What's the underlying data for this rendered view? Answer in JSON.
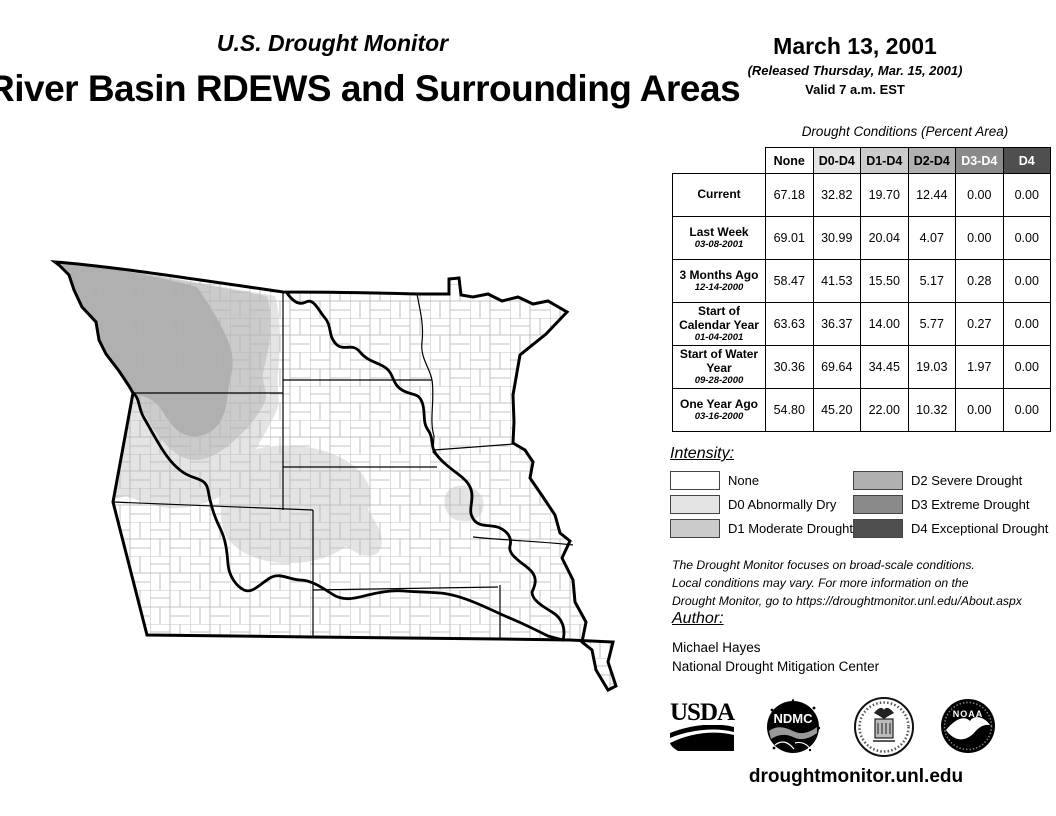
{
  "header": {
    "monitor_title": "U.S. Drought Monitor",
    "main_title": "River Basin RDEWS and Surrounding Areas",
    "date": "March 13, 2001",
    "released": "(Released Thursday, Mar. 15, 2001)",
    "valid": "Valid 7 a.m. EST"
  },
  "table": {
    "title": "Drought Conditions (Percent Area)",
    "columns": [
      "None",
      "D0-D4",
      "D1-D4",
      "D2-D4",
      "D3-D4",
      "D4"
    ],
    "header_bg": [
      "#ffffff",
      "#e4e4e4",
      "#cbcbcb",
      "#b0b0b0",
      "#8a8a8a",
      "#4f4f4f"
    ],
    "header_fg": [
      "#000000",
      "#000000",
      "#000000",
      "#000000",
      "#ffffff",
      "#ffffff"
    ],
    "rows": [
      {
        "label": "Current",
        "date": "",
        "values": [
          "67.18",
          "32.82",
          "19.70",
          "12.44",
          "0.00",
          "0.00"
        ]
      },
      {
        "label": "Last Week",
        "date": "03-08-2001",
        "values": [
          "69.01",
          "30.99",
          "20.04",
          "4.07",
          "0.00",
          "0.00"
        ]
      },
      {
        "label": "3 Months Ago",
        "date": "12-14-2000",
        "values": [
          "58.47",
          "41.53",
          "15.50",
          "5.17",
          "0.28",
          "0.00"
        ]
      },
      {
        "label": "Start of Calendar Year",
        "date": "01-04-2001",
        "values": [
          "63.63",
          "36.37",
          "14.00",
          "5.77",
          "0.27",
          "0.00"
        ]
      },
      {
        "label": "Start of Water Year",
        "date": "09-28-2000",
        "values": [
          "30.36",
          "69.64",
          "34.45",
          "19.03",
          "1.97",
          "0.00"
        ]
      },
      {
        "label": "One Year Ago",
        "date": "03-16-2000",
        "values": [
          "54.80",
          "45.20",
          "22.00",
          "10.32",
          "0.00",
          "0.00"
        ]
      }
    ]
  },
  "legend": {
    "title": "Intensity:",
    "items": [
      {
        "label": "None",
        "color": "#ffffff"
      },
      {
        "label": "D0 Abnormally Dry",
        "color": "#e4e4e4"
      },
      {
        "label": "D1 Moderate Drought",
        "color": "#cbcbcb"
      },
      {
        "label": "D2 Severe Drought",
        "color": "#b0b0b0"
      },
      {
        "label": "D3 Extreme Drought",
        "color": "#8a8a8a"
      },
      {
        "label": "D4 Exceptional Drought",
        "color": "#4f4f4f"
      }
    ]
  },
  "disclaimer": {
    "text": "The Drought Monitor focuses on broad-scale conditions.\nLocal conditions may vary. For more information on the\nDrought Monitor, go to https://droughtmonitor.unl.edu/About.aspx"
  },
  "author": {
    "title": "Author:",
    "name": "Michael Hayes",
    "org": "National Drought Mitigation Center"
  },
  "logos": {
    "usda_label": "USDA",
    "ndmc_label": "NDMC",
    "noaa_label": "NOAA"
  },
  "footer": {
    "url": "droughtmonitor.unl.edu"
  },
  "map": {
    "drought_regions": [
      {
        "area": "western-montana",
        "intensity": "D2 Severe Drought"
      },
      {
        "area": "central-montana-northwest-wyoming",
        "intensity": "D1 Moderate Drought"
      },
      {
        "area": "eastern-montana-western-wyoming",
        "intensity": "D0 Abnormally Dry"
      },
      {
        "area": "central-south-dakota-nebraska-border",
        "intensity": "D0 Abnormally Dry"
      },
      {
        "area": "eastern-nebraska-western-iowa",
        "intensity": "D0 Abnormally Dry"
      },
      {
        "area": "southeast-missouri-bootheel",
        "intensity": "D0 Abnormally Dry"
      }
    ]
  }
}
